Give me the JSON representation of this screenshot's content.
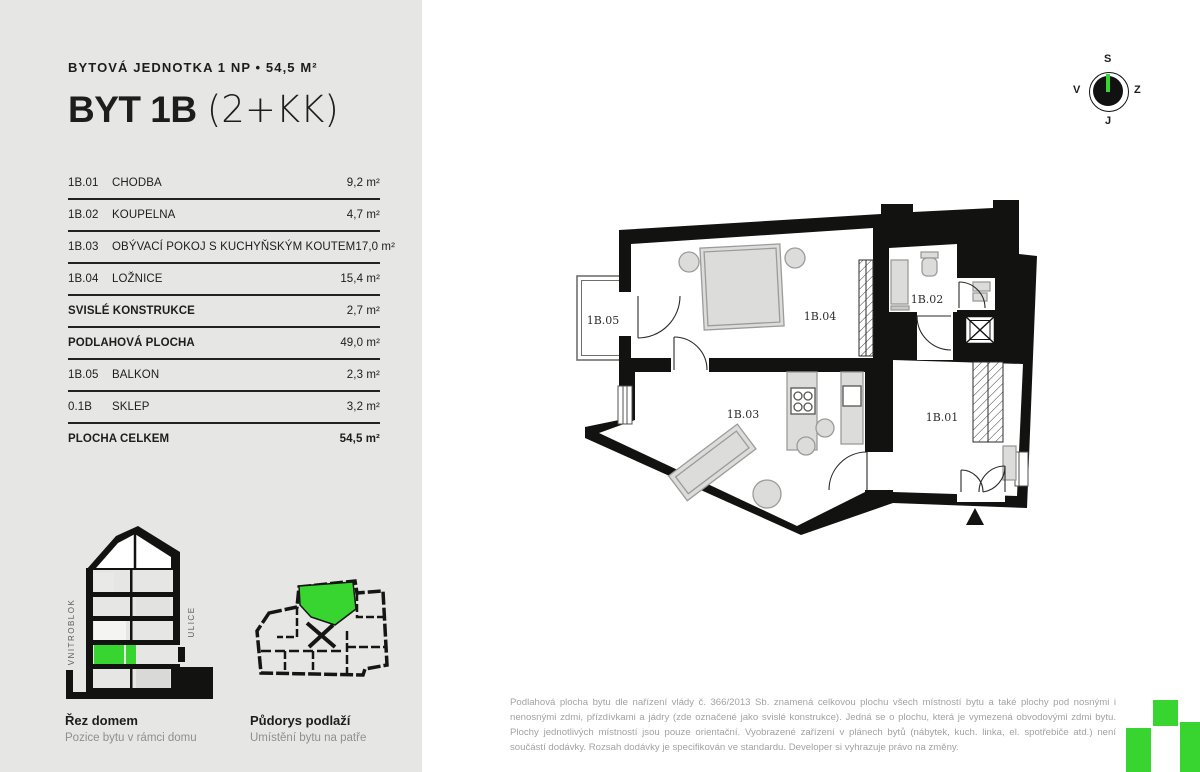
{
  "page": {
    "bg_left": "#e6e6e4",
    "bg_right": "#ffffff",
    "accent_green": "#38d430",
    "ink": "#1d1d1b"
  },
  "header": {
    "subtitle": "BYTOVÁ JEDNOTKA 1 NP • 54,5 M²",
    "title_bold": "BYT 1B",
    "title_light": "(2+KK)"
  },
  "area_table": {
    "rows": [
      {
        "code": "1B.01",
        "name": "CHODBA",
        "area": "9,2 m²"
      },
      {
        "code": "1B.02",
        "name": "KOUPELNA",
        "area": "4,7 m²"
      },
      {
        "code": "1B.03",
        "name": "OBÝVACÍ POKOJ S KUCHYŇSKÝM KOUTEM",
        "area": "17,0 m²"
      },
      {
        "code": "1B.04",
        "name": "LOŽNICE",
        "area": "15,4 m²"
      },
      {
        "code": "",
        "name": "SVISLÉ KONSTRUKCE",
        "area": "2,7 m²"
      },
      {
        "code": "",
        "name": "PODLAHOVÁ PLOCHA",
        "area": "49,0 m²"
      },
      {
        "code": "1B.05",
        "name": "BALKON",
        "area": "2,3 m²"
      },
      {
        "code": "0.1B",
        "name": "SKLEP",
        "area": "3,2 m²"
      },
      {
        "code": "",
        "name": "PLOCHA CELKEM",
        "area": "54,5 m²"
      }
    ]
  },
  "compass": {
    "top": "S",
    "left": "V",
    "right": "Z",
    "bottom": "J"
  },
  "floor_plan": {
    "rooms": {
      "hall": "1B.01",
      "bathroom": "1B.02",
      "living": "1B.03",
      "bedroom": "1B.04",
      "balcony": "1B.05"
    }
  },
  "section_figure": {
    "title": "Řez domem",
    "subtitle": "Pozice bytu v rámci domu",
    "left_axis": "VNITROBLOK",
    "right_axis": "ULICE"
  },
  "mini_plan_figure": {
    "title": "Půdorys podlaží",
    "subtitle": "Umístění bytu na patře"
  },
  "disclaimer": "Podlahová plocha bytu dle nařízení vlády č. 366/2013 Sb. znamená celkovou plochu všech místností bytu a také plochy pod nosnými i nenosnými zdmi, přízdívkami a jádry (zde označené jako svislé konstrukce). Jedná se o plochu, která je vymezená obvodovými zdmi bytu. Plochy jednotlivých místností jsou pouze orientační. Vyobrazené zařízení v plánech bytů (nábytek, kuch. linka, el. spotřebiče atd.) není součástí dodávky. Rozsah dodávky je specifikován ve standardu. Developer si vyhrazuje právo na změny."
}
